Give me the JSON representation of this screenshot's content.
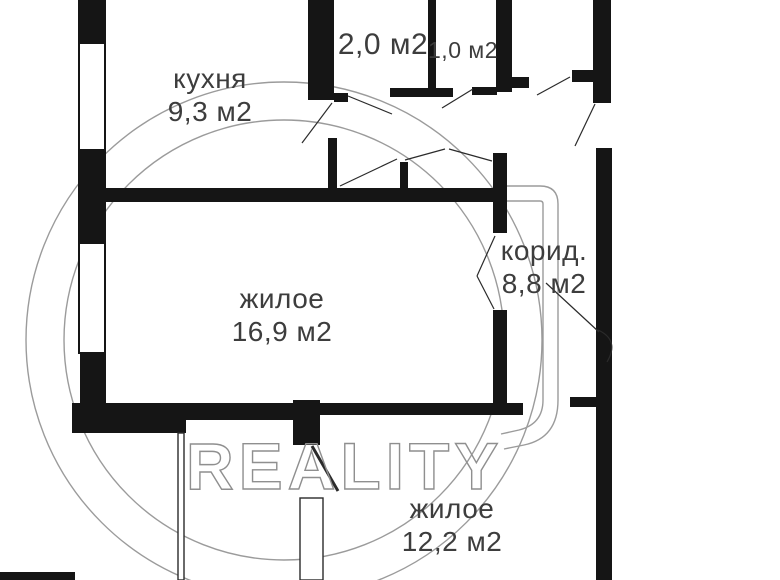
{
  "watermark": {
    "text": "REALITY"
  },
  "rooms": [
    {
      "id": "kitchen",
      "name": "кухня",
      "area": "9,3 м2"
    },
    {
      "id": "storage-2",
      "name": "",
      "area": "2,0 м2"
    },
    {
      "id": "storage-1",
      "name": "",
      "area": "1,0 м2"
    },
    {
      "id": "corridor",
      "name": "корид.",
      "area": "8,8 м2"
    },
    {
      "id": "living-16",
      "name": "жилое",
      "area": "16,9 м2"
    },
    {
      "id": "living-12",
      "name": "жилое",
      "area": "12,2 м2"
    }
  ],
  "colors": {
    "wall": "#151515",
    "thin_line": "#2b2b2b",
    "watermark": "#8f8f8f",
    "label_text": "#3d3d3d",
    "background": "#ffffff"
  }
}
